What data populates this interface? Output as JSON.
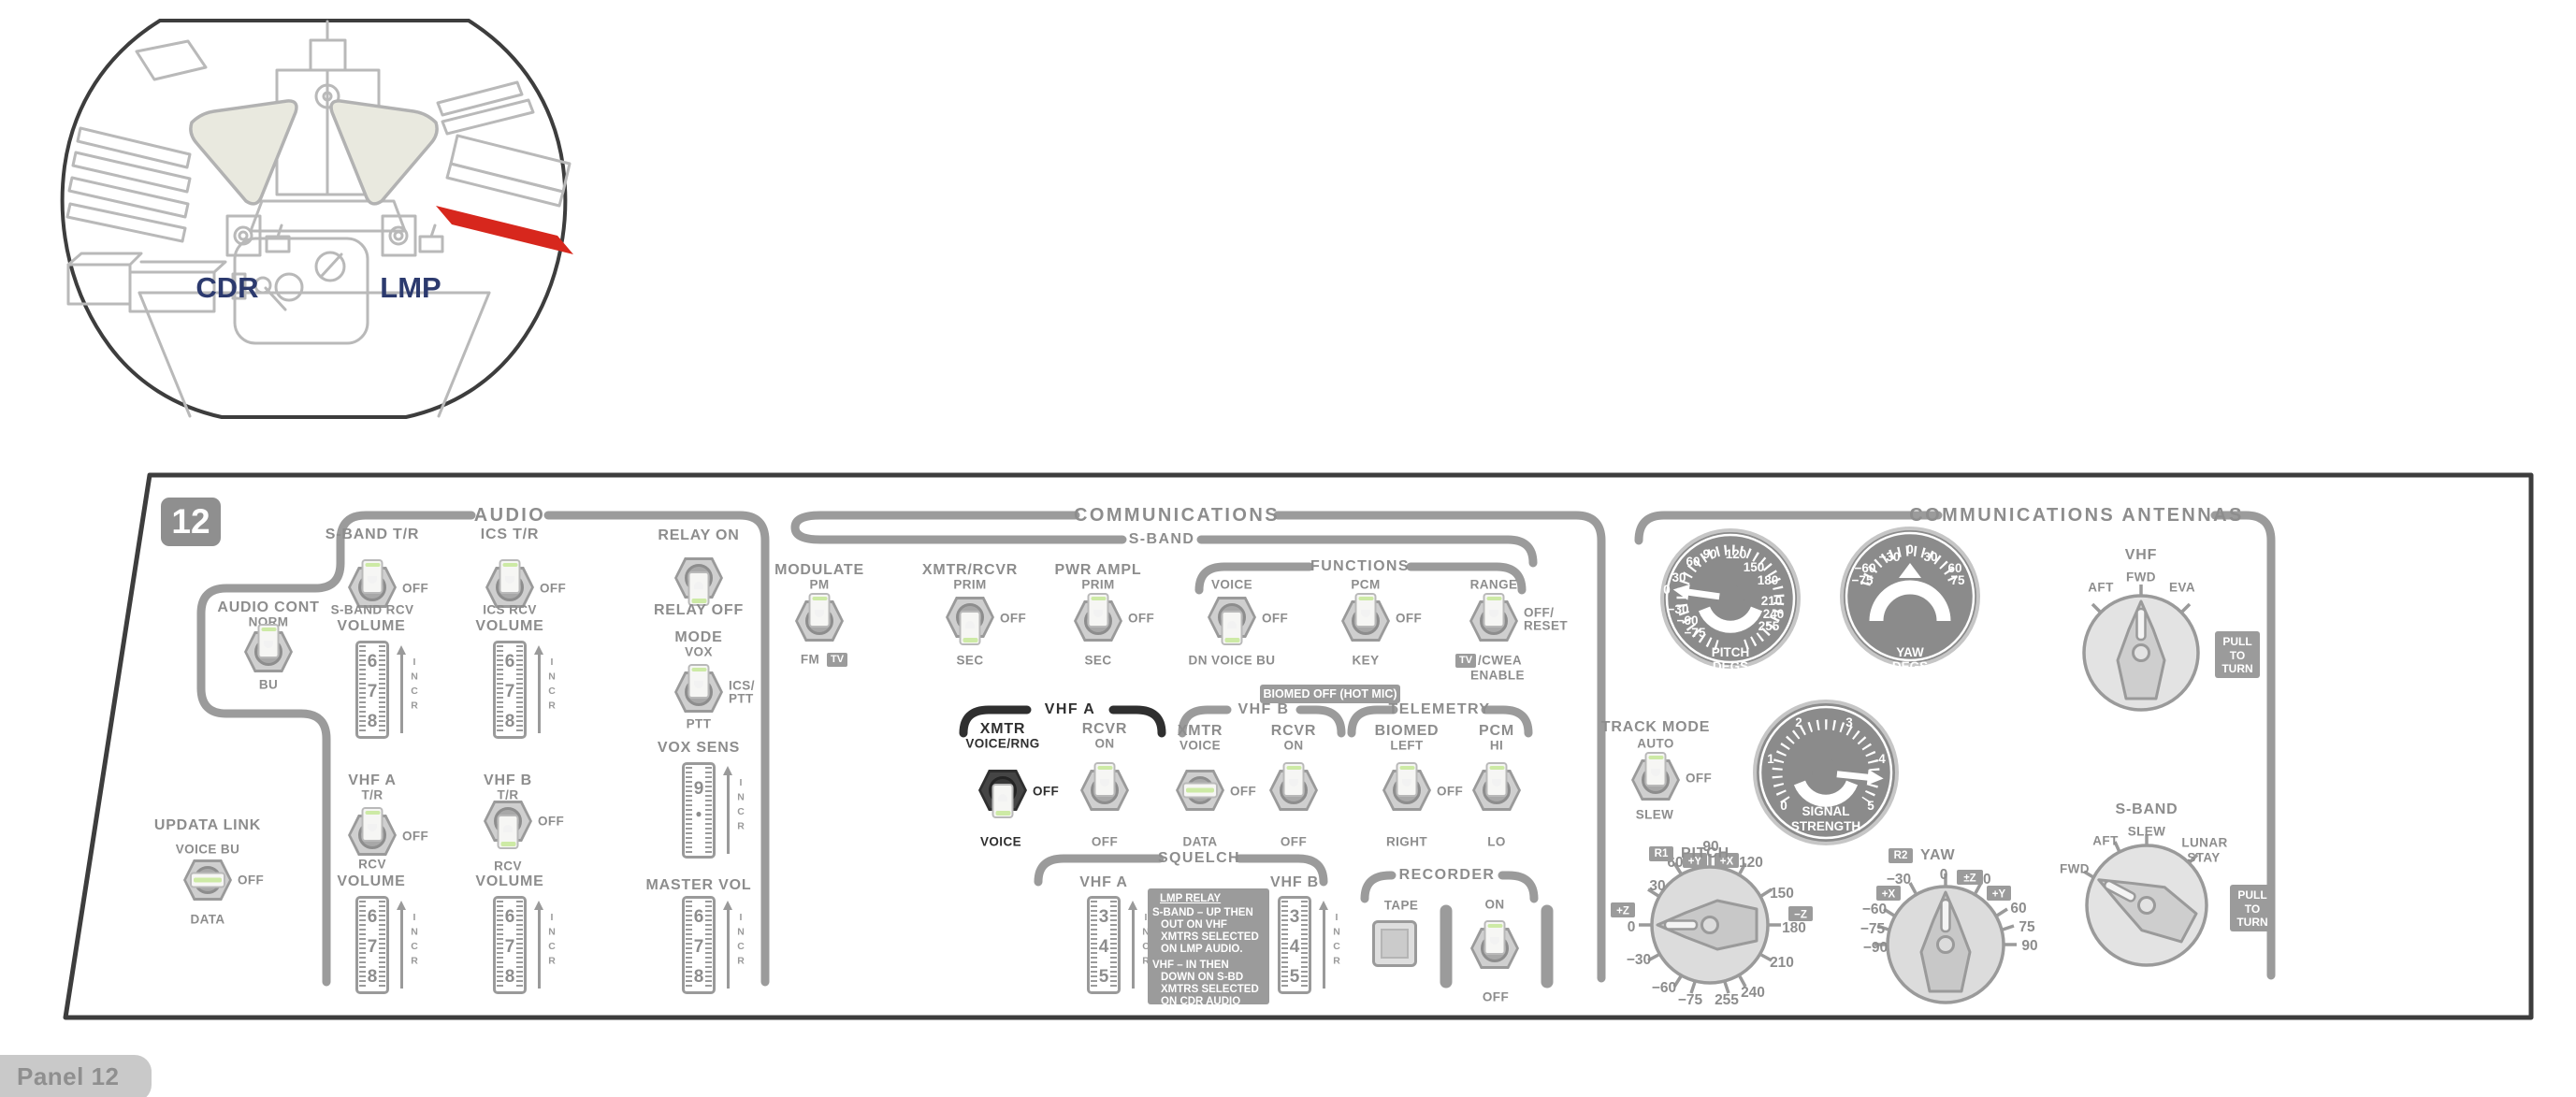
{
  "inset": {
    "cdr": "CDR",
    "lmp": "LMP"
  },
  "panel_number": "12",
  "footer": {
    "label": "Panel 12"
  },
  "headers": {
    "audio": "AUDIO",
    "communications": "COMMUNICATIONS",
    "comm_antennas": "COMMUNICATIONS ANTENNAS",
    "s_band": "S-BAND",
    "functions": "FUNCTIONS",
    "vhf_a": "VHF A",
    "vhf_b": "VHF B",
    "telemetry": "TELEMETRY",
    "squelch": "SQUELCH",
    "recorder": "RECORDER"
  },
  "audio": {
    "s_band_tr": {
      "label": "S-BAND T/R",
      "off": "OFF",
      "bottom": "S-BAND RCV",
      "volume": "VOLUME",
      "wheel": [
        "6",
        "7",
        "8"
      ],
      "incr": "INCR"
    },
    "ics_tr": {
      "label": "ICS T/R",
      "off": "OFF",
      "bottom": "ICS RCV",
      "volume": "VOLUME",
      "wheel": [
        "6",
        "7",
        "8"
      ],
      "incr": "INCR"
    },
    "relay": {
      "top": "RELAY ON",
      "bottom": "RELAY OFF"
    },
    "mode": {
      "title": "MODE",
      "top": "VOX",
      "right1": "ICS/",
      "right2": "PTT",
      "bottom": "PTT"
    },
    "vox_sens": {
      "title": "VOX SENS",
      "wheel": [
        "9",
        "●"
      ],
      "incr": "INCR"
    },
    "master_vol": {
      "title": "MASTER VOL",
      "wheel": [
        "6",
        "7",
        "8"
      ],
      "incr": "INCR"
    },
    "audio_cont": {
      "title": "AUDIO CONT",
      "top": "NORM",
      "bottom": "BU"
    },
    "updata_link": {
      "title": "UPDATA LINK",
      "top": "VOICE BU",
      "off": "OFF",
      "bottom": "DATA"
    },
    "vhf_a": {
      "title": "VHF A",
      "top": "T/R",
      "off": "OFF",
      "bottom": "RCV",
      "volume": "VOLUME",
      "wheel": [
        "6",
        "7",
        "8"
      ],
      "incr": "INCR"
    },
    "vhf_b": {
      "title": "VHF B",
      "top": "T/R",
      "off": "OFF",
      "bottom": "RCV",
      "volume": "VOLUME",
      "wheel": [
        "6",
        "7",
        "8"
      ],
      "incr": "INCR"
    }
  },
  "comm": {
    "modulate": {
      "title": "MODULATE",
      "top": "PM",
      "fm": "FM",
      "tv": "TV"
    },
    "xmtr_rcvr": {
      "title": "XMTR/RCVR",
      "top": "PRIM",
      "off": "OFF",
      "bottom": "SEC"
    },
    "pwr_ampl": {
      "title": "PWR AMPL",
      "top": "PRIM",
      "off": "OFF",
      "bottom": "SEC"
    },
    "func_voice": {
      "top": "VOICE",
      "off": "OFF",
      "bottom": "DN VOICE BU"
    },
    "func_pcm": {
      "top": "PCM",
      "off": "OFF",
      "bottom": "KEY"
    },
    "func_range": {
      "top": "RANGE",
      "right1": "OFF/",
      "right2": "RESET",
      "tv": "TV",
      "cwea": "/CWEA",
      "enable": "ENABLE"
    },
    "biomed_badge": "BIOMED OFF (HOT MIC)",
    "vhf_a_xmtr": {
      "title": "XMTR",
      "sub": "VOICE/RNG",
      "off": "OFF",
      "bottom": "VOICE"
    },
    "vhf_a_rcvr": {
      "title": "RCVR",
      "sub": "ON",
      "bottom": "OFF"
    },
    "vhf_b_xmtr": {
      "title": "XMTR",
      "sub": "VOICE",
      "off": "OFF",
      "bottom": "DATA"
    },
    "vhf_b_rcvr": {
      "title": "RCVR",
      "sub": "ON",
      "bottom": "OFF"
    },
    "tlm_biomed": {
      "title": "BIOMED",
      "sub": "LEFT",
      "off": "OFF",
      "bottom": "RIGHT"
    },
    "tlm_pcm": {
      "title": "PCM",
      "sub": "HI",
      "bottom": "LO"
    },
    "squelch_a": {
      "label": "VHF A",
      "wheel": [
        "3",
        "4",
        "5"
      ],
      "incr": "INCR"
    },
    "squelch_b": {
      "label": "VHF B",
      "wheel": [
        "3",
        "4",
        "5"
      ],
      "incr": "INCR"
    },
    "lmp_note": {
      "title": "LMP RELAY",
      "p1": [
        "S-BAND – UP THEN",
        "OUT ON VHF",
        "XMTRS SELECTED",
        "ON LMP AUDIO."
      ],
      "p2": [
        "VHF – IN THEN",
        "DOWN ON S-BD",
        "XMTRS SELECTED",
        "ON CDR AUDIO"
      ]
    },
    "recorder": {
      "tape": "TAPE",
      "on": "ON",
      "off": "OFF"
    }
  },
  "ant": {
    "pitch_gauge": {
      "t1": "PITCH",
      "t2": "DEGS",
      "labels": [
        "0",
        "30",
        "60",
        "90",
        "120",
        "150",
        "180",
        "210",
        "240",
        "255",
        "−30",
        "−60",
        "−75"
      ]
    },
    "yaw_gauge": {
      "t1": "YAW",
      "t2": "DEGS",
      "labels": [
        "0",
        "30",
        "60",
        "75",
        "−30",
        "−60",
        "−75"
      ]
    },
    "signal_gauge": {
      "t1": "SIGNAL",
      "t2": "STRENGTH",
      "labels": [
        "0",
        "1",
        "2",
        "3",
        "4",
        "5"
      ]
    },
    "track_mode": {
      "title": "TRACK MODE",
      "top": "AUTO",
      "off": "OFF",
      "bottom": "SLEW"
    },
    "pitch_dial": {
      "r": "R1",
      "title": "PITCH",
      "labels": [
        "0",
        "30",
        "60",
        "90",
        "120",
        "150",
        "180",
        "210",
        "240",
        "255",
        "−30",
        "−60",
        "−75"
      ],
      "zp": "+Z",
      "zm": "−Z",
      "yp": "+Y",
      "xp": "+X"
    },
    "yaw_dial": {
      "r": "R2",
      "title": "YAW",
      "labels": [
        "0",
        "30",
        "60",
        "75",
        "90",
        "−30",
        "−60",
        "−75",
        "−90"
      ],
      "zpm": "±Z",
      "yp": "+Y",
      "xp": "+X"
    },
    "vhf_knob": {
      "title": "VHF",
      "aft": "AFT",
      "fwd": "FWD",
      "eva": "EVA"
    },
    "sband_knob": {
      "title": "S-BAND",
      "fwd": "FWD",
      "aft": "AFT",
      "slew": "SLEW",
      "lunar1": "LUNAR",
      "lunar2": "STAY"
    },
    "pull": [
      "PULL",
      "TO",
      "TURN"
    ]
  },
  "colors": {
    "accent_red": "#d7271d",
    "structure_gray": "#9b9b9b",
    "label_gray": "#8d8d8d",
    "highlight_black": "#2f2f2f",
    "green_stripe": "#cdeaa5",
    "navy": "#2c3a6e"
  }
}
